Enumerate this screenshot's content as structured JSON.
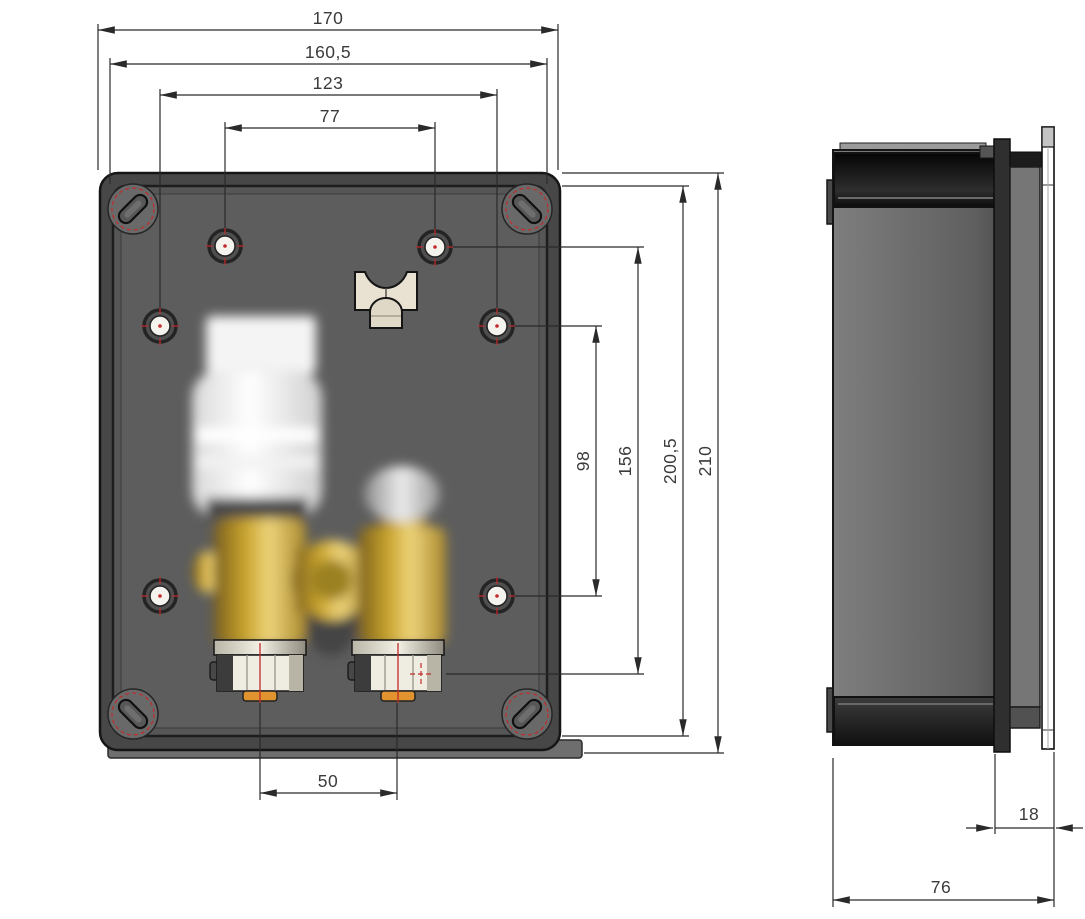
{
  "dims": {
    "front": {
      "outer_width": "170",
      "inner_width": "160,5",
      "hole_span_outer": "123",
      "hole_span_inner": "77",
      "hole_row_gap": "98",
      "top_hole_to_valve": "156",
      "inner_height": "200,5",
      "outer_height": "210",
      "valve_spacing": "50"
    },
    "side": {
      "protrusion_depth": "18",
      "total_depth": "76"
    }
  },
  "colors": {
    "background": "#ffffff",
    "box_gray": "#4e4e4e",
    "dimension_line": "#2a2a2a",
    "centerline_red": "#c22b2b",
    "brass": "#c9a43a",
    "clamp_beige": "#e9e1d1"
  }
}
